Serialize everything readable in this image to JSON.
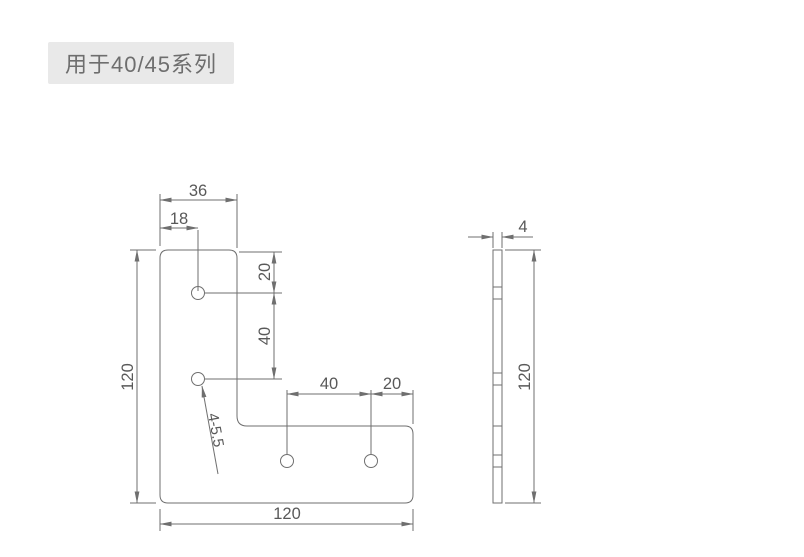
{
  "label": {
    "series_text": "用于40/45系列"
  },
  "colors": {
    "background": "#ffffff",
    "line": "#6f6f6f",
    "dim_text": "#595959",
    "label_bg": "#e9e9e9",
    "label_text": "#6e6e6e"
  },
  "front_view": {
    "description": "L-shape corner plate front view",
    "dimensions": {
      "arm_width": "36",
      "hole_center_from_left": "18",
      "first_hole_from_top": "20",
      "vertical_hole_pitch": "40",
      "overall_height": "120",
      "horizontal_hole_pitch": "40",
      "last_hole_from_right": "20",
      "overall_width": "120",
      "hole_callout": "4-5.5"
    },
    "hole_count": 4
  },
  "side_view": {
    "description": "plate edge view",
    "dimensions": {
      "thickness": "4",
      "overall_height": "120"
    }
  }
}
